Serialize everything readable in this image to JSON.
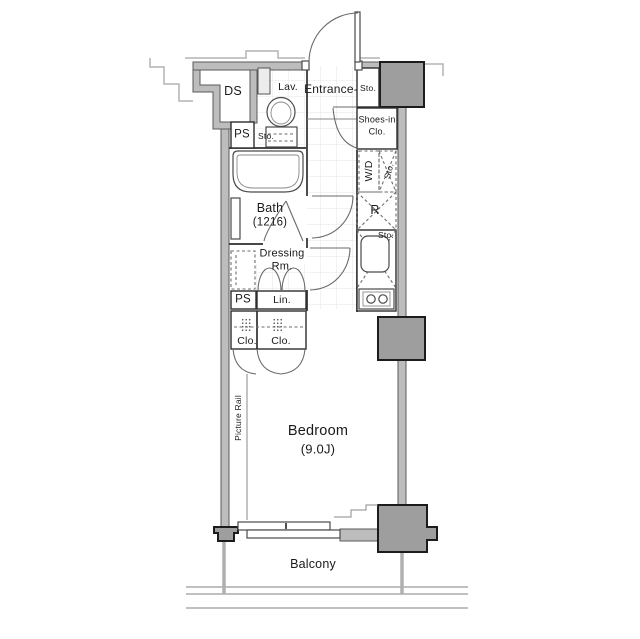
{
  "labels": {
    "ds": "DS",
    "ps_upper": "PS",
    "lav": "Lav.",
    "lav_sto": "Sto.",
    "entrance": "Entrance-",
    "entrance_sto": "Sto.",
    "shoes_in_line1": "Shoes-in",
    "shoes_in_line2": "Clo.",
    "washer_dryer": "W/D",
    "washer_dryer_sto": "Sto.",
    "refrigerator": "R",
    "kitchen_sto": "Sto.",
    "bath_line1": "Bath",
    "bath_line2": "(1216)",
    "dressing_line1": "Dressing",
    "dressing_line2": "Rm.",
    "linen": "Lin.",
    "ps_lower": "PS",
    "closet_left": "Clo.",
    "closet_right": "Clo.",
    "picture_rail": "Picture Rail",
    "bedroom_line1": "Bedroom",
    "bedroom_line2": "(9.0J)",
    "balcony": "Balcony"
  },
  "colors": {
    "background": "#ffffff",
    "wall": "#bdbdbd",
    "column": "#9e9e9e",
    "outline": "#2e2e2e",
    "light_line": "#b3b3b3",
    "tile": "#e4e4e4",
    "balcony_line": "#9a9a9a",
    "text": "#1a1a1a"
  }
}
